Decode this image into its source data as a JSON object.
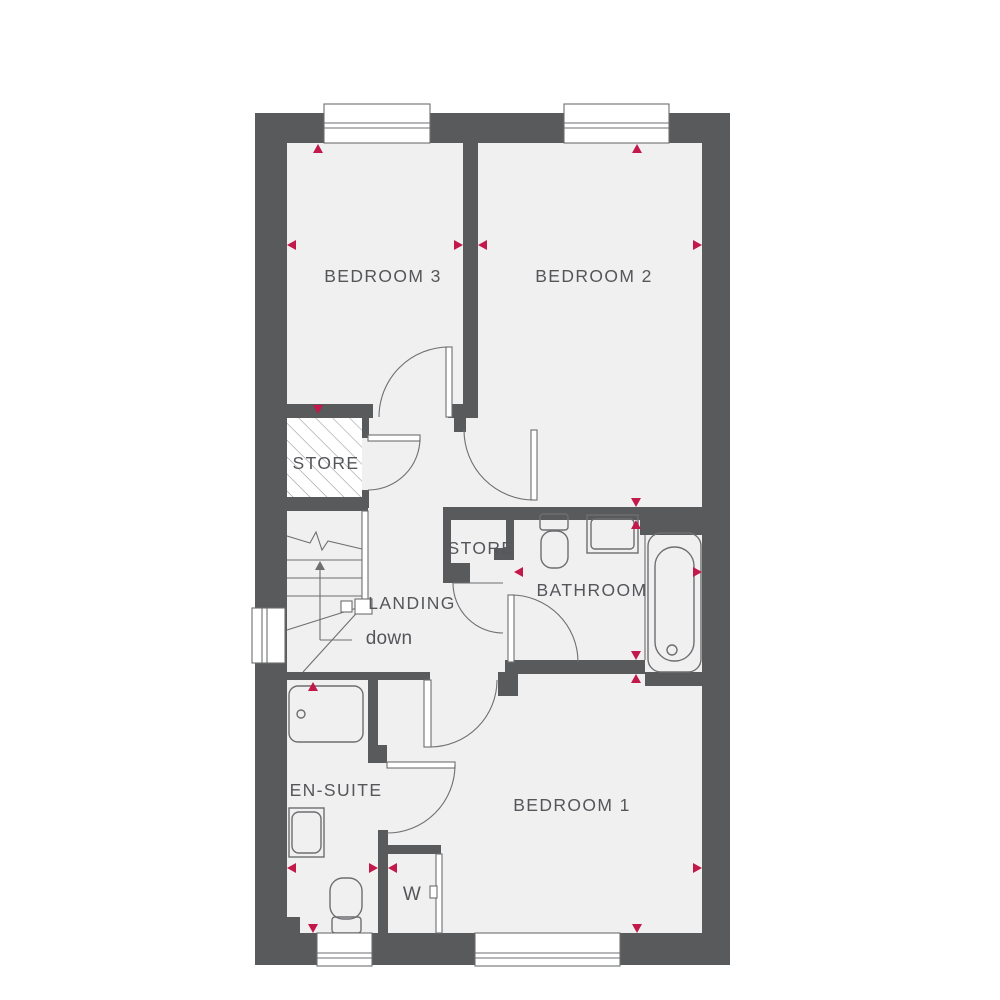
{
  "colors": {
    "wall": "#595A5C",
    "floor": "#F0F0F1",
    "line": "#6D6E70",
    "hatch": "#9B9C9E",
    "accent": "#C2194A",
    "text": "#55565A"
  },
  "rooms": {
    "bedroom3": {
      "label": "BEDROOM 3"
    },
    "bedroom2": {
      "label": "BEDROOM 2"
    },
    "bedroom1": {
      "label": "BEDROOM 1"
    },
    "bathroom": {
      "label": "BATHROOM"
    },
    "ensuite": {
      "label": "EN-SUITE"
    },
    "landing": {
      "label": "LANDING"
    },
    "store_upper": {
      "label": "STORE"
    },
    "store_inner": {
      "label": "STORE"
    },
    "wardrobe": {
      "label": "W"
    }
  },
  "stairs": {
    "direction_label": "down"
  }
}
